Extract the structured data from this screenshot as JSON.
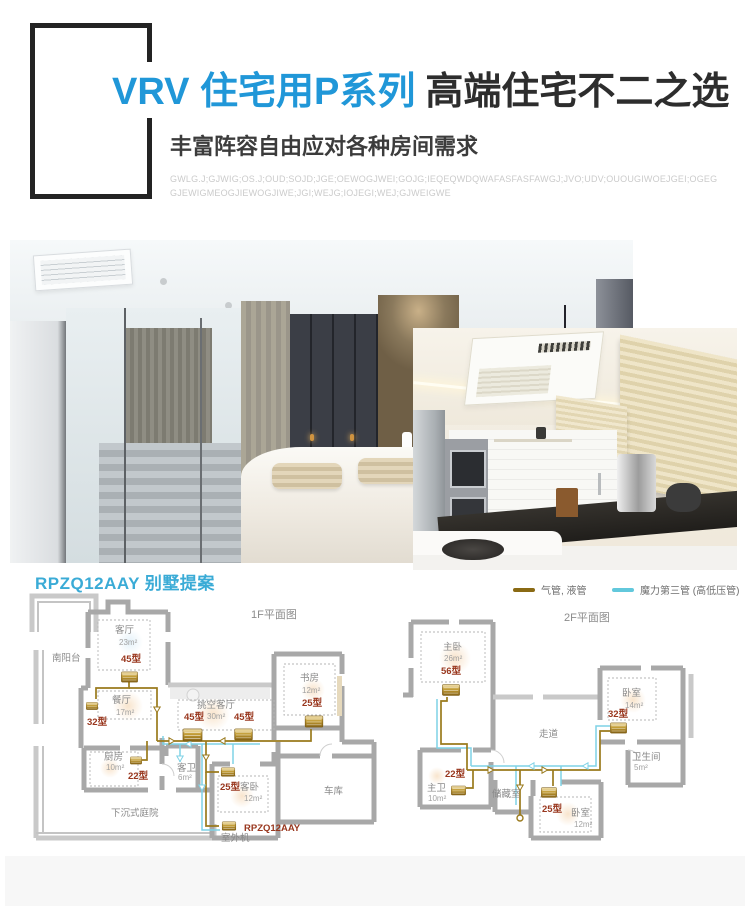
{
  "header": {
    "title_blue": "VRV 住宅用P系列",
    "title_dark": "高端住宅不二之选",
    "subtitle": "丰富阵容自由应对各种房间需求",
    "fine_print_line1": "GWLG.J;GJWIG;OS.J;OUD;SOJD;JGE;OEWOGJWEI;GOJG;IEQEQWDQWAFASFASFAWGJ;JVO;UDV;OUOUGIWOEJGEI;OGEG",
    "fine_print_line2": "GJEWIGMEOGJIEWOGJIWE;JGI;WEJG;IOJEGI;WEJ;GJWEIGWE",
    "accent_color": "#2097d8"
  },
  "gallery": {
    "left_photo": "bedroom-interior-photo",
    "right_photo": "kitchen-interior-photo"
  },
  "plan_section": {
    "title": "RPZQ12AAY 别墅提案",
    "legend": [
      {
        "label": "气管, 液管",
        "color": "#8a6a14"
      },
      {
        "label": "魔力第三管 (高低压管)",
        "color": "#62c8dc"
      }
    ],
    "pipe_gas_color": "#9a7a1c",
    "pipe_third_color": "#7fd2e6",
    "model_label_color": "#99371e",
    "floor1": {
      "caption": "1F平面图",
      "living": {
        "name": "客厅",
        "area": "23m²",
        "model": "45型"
      },
      "balcony": {
        "name": "南阳台"
      },
      "dining": {
        "name": "餐厅",
        "area": "17m²",
        "model": "32型"
      },
      "void_living": {
        "name": "挑空客厅",
        "area": "30m²",
        "model_left": "45型",
        "model_right": "45型"
      },
      "study": {
        "name": "书房",
        "area": "12m²",
        "model": "25型"
      },
      "kitchen": {
        "name": "厨房",
        "area": "10m²",
        "model": "22型"
      },
      "guest_bath": {
        "name": "客卫",
        "area": "6m²"
      },
      "guest_bed": {
        "name": "客卧",
        "area": "12m²",
        "model": "25型"
      },
      "garage": {
        "name": "车库"
      },
      "courtyard": {
        "name": "下沉式庭院"
      },
      "outdoor_unit": {
        "model": "RPZQ12AAY",
        "label": "室外机"
      }
    },
    "floor2": {
      "caption": "2F平面图",
      "master_bed": {
        "name": "主卧",
        "area": "26m²",
        "model": "56型"
      },
      "corridor": {
        "name": "走道"
      },
      "bedroom_east": {
        "name": "卧室",
        "area": "14m²",
        "model": "32型"
      },
      "bathroom": {
        "name": "卫生间",
        "area": "5m²"
      },
      "master_bath": {
        "name": "主卫",
        "area": "10m²",
        "model": "22型"
      },
      "storage": {
        "name": "储藏室"
      },
      "bedroom_south": {
        "name": "卧室",
        "area": "12m²",
        "model": "25型"
      }
    }
  }
}
